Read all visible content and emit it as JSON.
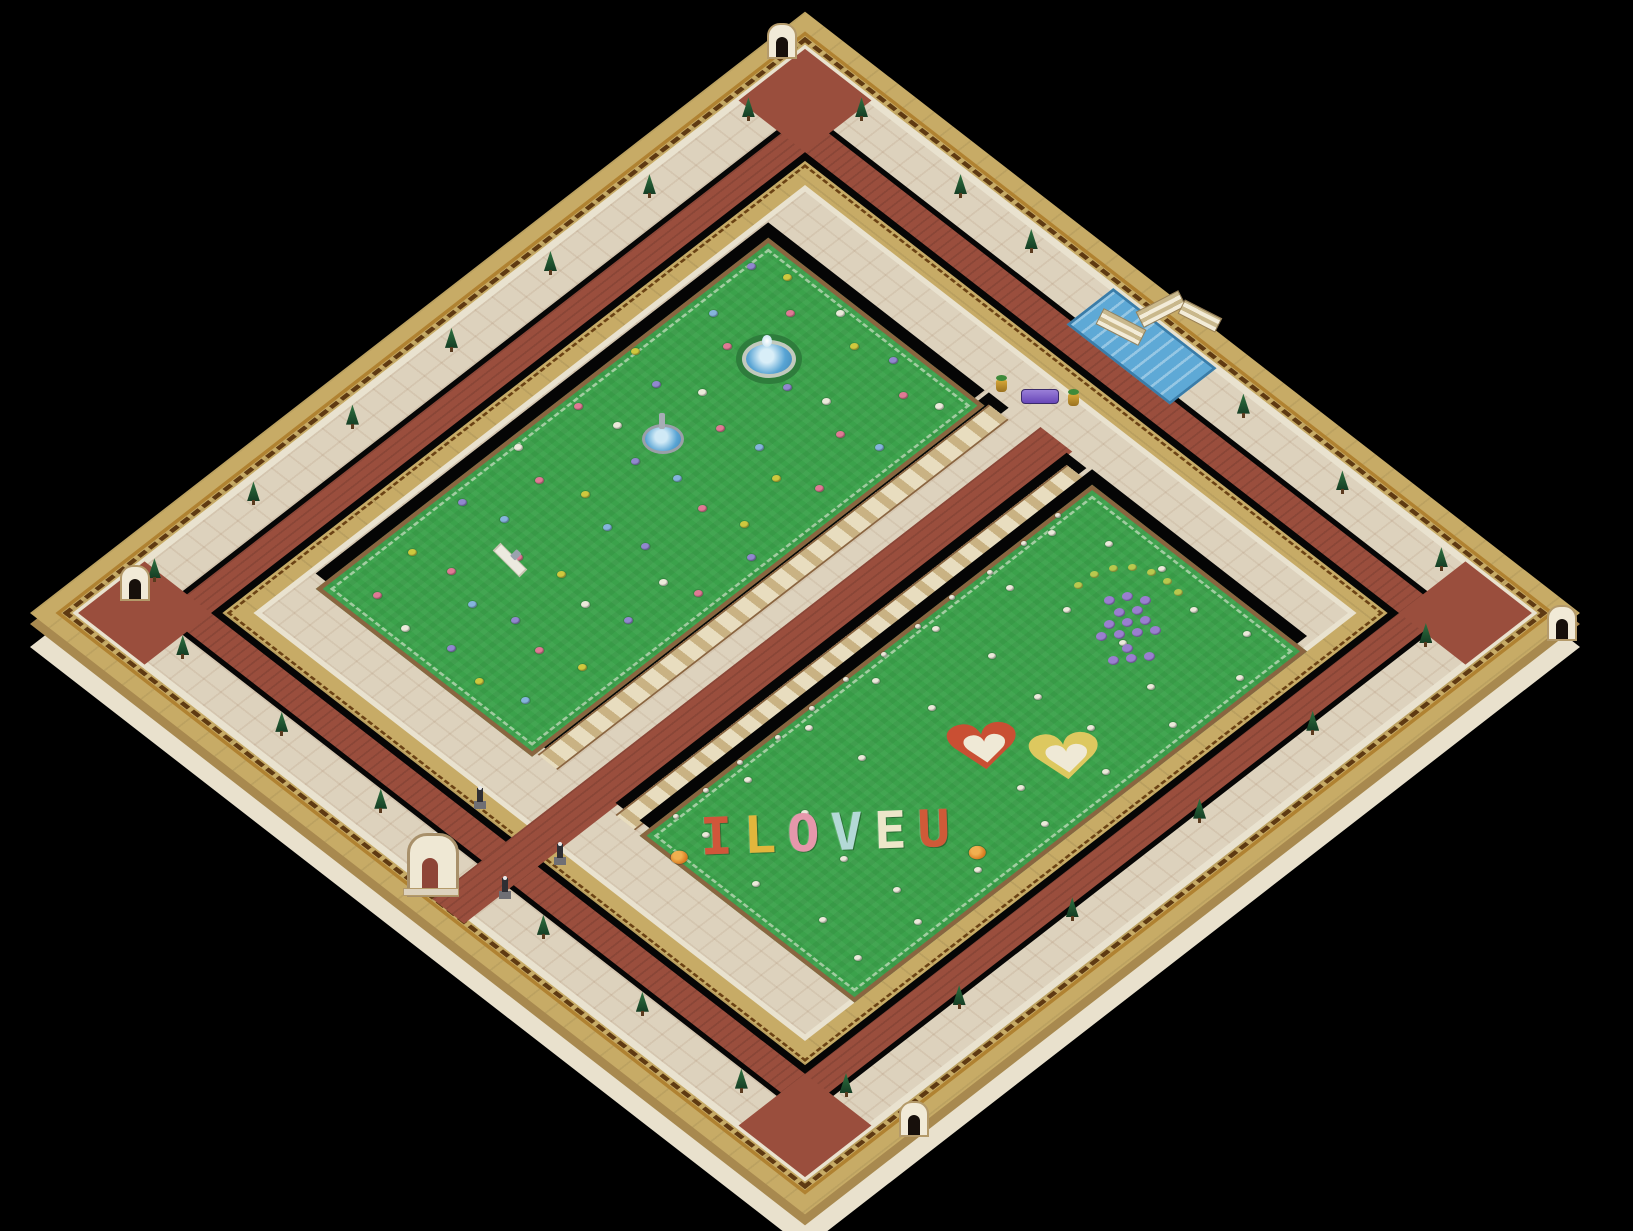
{
  "scene": {
    "background": "#000000",
    "style": "isometric-walled-garden-park"
  },
  "iso": {
    "cx": 805,
    "cy": 613,
    "kx": 0.7071,
    "ky": 0.5487,
    "n": 1096
  },
  "palette": {
    "grass": "#3ba24b",
    "path_cream": "#ddd2bd",
    "path_red": "#9a4e3d",
    "wall_top": "#c7ab66",
    "wall_face": "#e9e2cf",
    "trim_gold": "#b08231",
    "trim_dark": "#5f3a12",
    "garden_border": "#8a6540",
    "edge_black": "#060606",
    "water": "#5ea9d6",
    "tree_green": "#2e7240",
    "colonnade": "#d9cba4"
  },
  "flower_text": {
    "text": "ILOVEU",
    "anchor": [
      781,
      720
    ],
    "letters": [
      {
        "char": "I",
        "color": "#d0563a"
      },
      {
        "char": "L",
        "color": "#e2b63c"
      },
      {
        "char": "O",
        "color": "#e697ab"
      },
      {
        "char": "V",
        "color": "#b3d9d6"
      },
      {
        "char": "E",
        "color": "#ece6c9"
      },
      {
        "char": "U",
        "color": "#cf5a38"
      }
    ]
  },
  "hearts": [
    {
      "name": "flower-heart-red",
      "anchor": [
        800,
        541
      ],
      "outline": "#c94f33",
      "fill": "#efe9d6"
    },
    {
      "name": "flower-heart-yellow",
      "anchor": [
        867,
        492
      ],
      "outline": "#ddc85f",
      "fill": "#efe9d6"
    }
  ],
  "flower_totem": {
    "anchor": [
      770,
      324
    ],
    "arc_color": "#b9c94e",
    "dot_color": "#9a7fd0",
    "arc": [
      [
        -46,
        -30
      ],
      [
        -30,
        -41
      ],
      [
        -11,
        -47
      ],
      [
        8,
        -48
      ],
      [
        27,
        -43
      ],
      [
        43,
        -34
      ],
      [
        54,
        -23
      ]
    ],
    "dots": [
      [
        -16,
        -16
      ],
      [
        2,
        -20
      ],
      [
        20,
        -16
      ],
      [
        -6,
        -4
      ],
      [
        12,
        -6
      ],
      [
        -16,
        8
      ],
      [
        2,
        6
      ],
      [
        20,
        4
      ],
      [
        -24,
        20
      ],
      [
        -6,
        18
      ],
      [
        12,
        16
      ],
      [
        30,
        14
      ],
      [
        2,
        32
      ],
      [
        -12,
        44
      ],
      [
        6,
        42
      ],
      [
        24,
        40
      ]
    ]
  },
  "fountains": [
    {
      "type": "wreath-fountain",
      "pos": [
        285,
        341
      ]
    },
    {
      "type": "statue-fountain",
      "pos": [
        284,
        489
      ]
    },
    {
      "type": "statue-plinth",
      "pos": [
        291,
        708
      ]
    }
  ],
  "statues": [
    [
      497,
      957
    ],
    [
      604,
      951
    ],
    [
      597,
      1021
    ],
    [
      507,
      1030
    ]
  ],
  "gates": [
    [
      22,
      57
    ],
    [
      58,
      1008
    ],
    [
      1104,
      36
    ],
    [
      1098,
      946
    ]
  ],
  "grand_gate": {
    "pos": [
      536,
      1066
    ]
  },
  "bridge": {
    "pos": [
      530,
      28
    ]
  },
  "bench": {
    "pos": [
      515,
      184
    ],
    "color": "#7a5bd0"
  },
  "trees": [
    [
      60,
      140
    ],
    [
      60,
      280
    ],
    [
      60,
      420
    ],
    [
      60,
      560
    ],
    [
      60,
      700
    ],
    [
      60,
      840
    ],
    [
      60,
      980
    ],
    [
      140,
      60
    ],
    [
      280,
      60
    ],
    [
      380,
      60
    ],
    [
      680,
      60
    ],
    [
      820,
      60
    ],
    [
      960,
      60
    ],
    [
      150,
      1030
    ],
    [
      290,
      1030
    ],
    [
      430,
      1030
    ],
    [
      660,
      1030
    ],
    [
      800,
      1030
    ],
    [
      940,
      1030
    ],
    [
      1018,
      140
    ],
    [
      1018,
      300
    ],
    [
      1018,
      460
    ],
    [
      1018,
      640
    ],
    [
      1018,
      800
    ],
    [
      1018,
      960
    ]
  ],
  "flowers": {
    "colors": [
      "#e07a95",
      "#9188cf",
      "#cfc93e",
      "#eceadb",
      "#85b4dd",
      "#cf5a3a"
    ],
    "left": [
      [
        195,
        270,
        1
      ],
      [
        230,
        255,
        2
      ],
      [
        265,
        285,
        0
      ],
      [
        300,
        250,
        3
      ],
      [
        340,
        270,
        2
      ],
      [
        380,
        255,
        1
      ],
      [
        420,
        280,
        0
      ],
      [
        455,
        265,
        3
      ],
      [
        210,
        340,
        4
      ],
      [
        250,
        360,
        0
      ],
      [
        290,
        330,
        2
      ],
      [
        330,
        355,
        1
      ],
      [
        370,
        340,
        3
      ],
      [
        410,
        360,
        0
      ],
      [
        450,
        345,
        4
      ],
      [
        190,
        430,
        2
      ],
      [
        235,
        445,
        1
      ],
      [
        275,
        420,
        3
      ],
      [
        320,
        440,
        0
      ],
      [
        365,
        430,
        4
      ],
      [
        405,
        445,
        2
      ],
      [
        445,
        425,
        0
      ],
      [
        200,
        520,
        0
      ],
      [
        245,
        510,
        3
      ],
      [
        290,
        530,
        1
      ],
      [
        335,
        515,
        4
      ],
      [
        380,
        525,
        0
      ],
      [
        425,
        510,
        2
      ],
      [
        460,
        535,
        1
      ],
      [
        195,
        600,
        3
      ],
      [
        240,
        615,
        0
      ],
      [
        285,
        595,
        2
      ],
      [
        330,
        610,
        4
      ],
      [
        375,
        600,
        1
      ],
      [
        420,
        620,
        3
      ],
      [
        455,
        605,
        0
      ],
      [
        205,
        690,
        1
      ],
      [
        250,
        675,
        4
      ],
      [
        295,
        700,
        0
      ],
      [
        340,
        685,
        2
      ],
      [
        385,
        695,
        3
      ],
      [
        430,
        680,
        1
      ],
      [
        215,
        770,
        2
      ],
      [
        260,
        760,
        0
      ],
      [
        305,
        775,
        4
      ],
      [
        350,
        760,
        1
      ],
      [
        395,
        770,
        0
      ],
      [
        440,
        755,
        2
      ],
      [
        230,
        835,
        0
      ],
      [
        280,
        845,
        3
      ],
      [
        330,
        830,
        1
      ],
      [
        380,
        840,
        2
      ],
      [
        430,
        825,
        4
      ]
    ],
    "right": [
      [
        650,
        300,
        3
      ],
      [
        700,
        270,
        3
      ],
      [
        760,
        255,
        3
      ],
      [
        820,
        270,
        3
      ],
      [
        880,
        255,
        3
      ],
      [
        915,
        300,
        3
      ],
      [
        670,
        380,
        3
      ],
      [
        730,
        360,
        3
      ],
      [
        800,
        350,
        3
      ],
      [
        860,
        370,
        3
      ],
      [
        910,
        390,
        3
      ],
      [
        655,
        470,
        3
      ],
      [
        720,
        455,
        3
      ],
      [
        790,
        460,
        3
      ],
      [
        855,
        450,
        3
      ],
      [
        905,
        480,
        3
      ],
      [
        660,
        560,
        3
      ],
      [
        725,
        545,
        3
      ],
      [
        860,
        555,
        3
      ],
      [
        910,
        570,
        3
      ],
      [
        655,
        650,
        3
      ],
      [
        720,
        640,
        3
      ],
      [
        905,
        660,
        3
      ],
      [
        660,
        740,
        3
      ],
      [
        730,
        730,
        3
      ],
      [
        800,
        745,
        3
      ],
      [
        865,
        735,
        3
      ],
      [
        910,
        750,
        3
      ],
      [
        680,
        820,
        3
      ],
      [
        760,
        830,
        3
      ],
      [
        840,
        815,
        3
      ],
      [
        900,
        825,
        3
      ]
    ],
    "edge_row": [
      [
        638,
        280,
        3
      ],
      [
        640,
        330,
        3
      ],
      [
        642,
        380,
        3
      ],
      [
        638,
        430,
        3
      ],
      [
        640,
        480,
        3
      ],
      [
        642,
        530,
        3
      ],
      [
        638,
        580,
        3
      ],
      [
        640,
        630,
        3
      ],
      [
        642,
        680,
        3
      ],
      [
        638,
        730,
        3
      ],
      [
        640,
        780,
        3
      ],
      [
        642,
        825,
        3
      ]
    ]
  }
}
